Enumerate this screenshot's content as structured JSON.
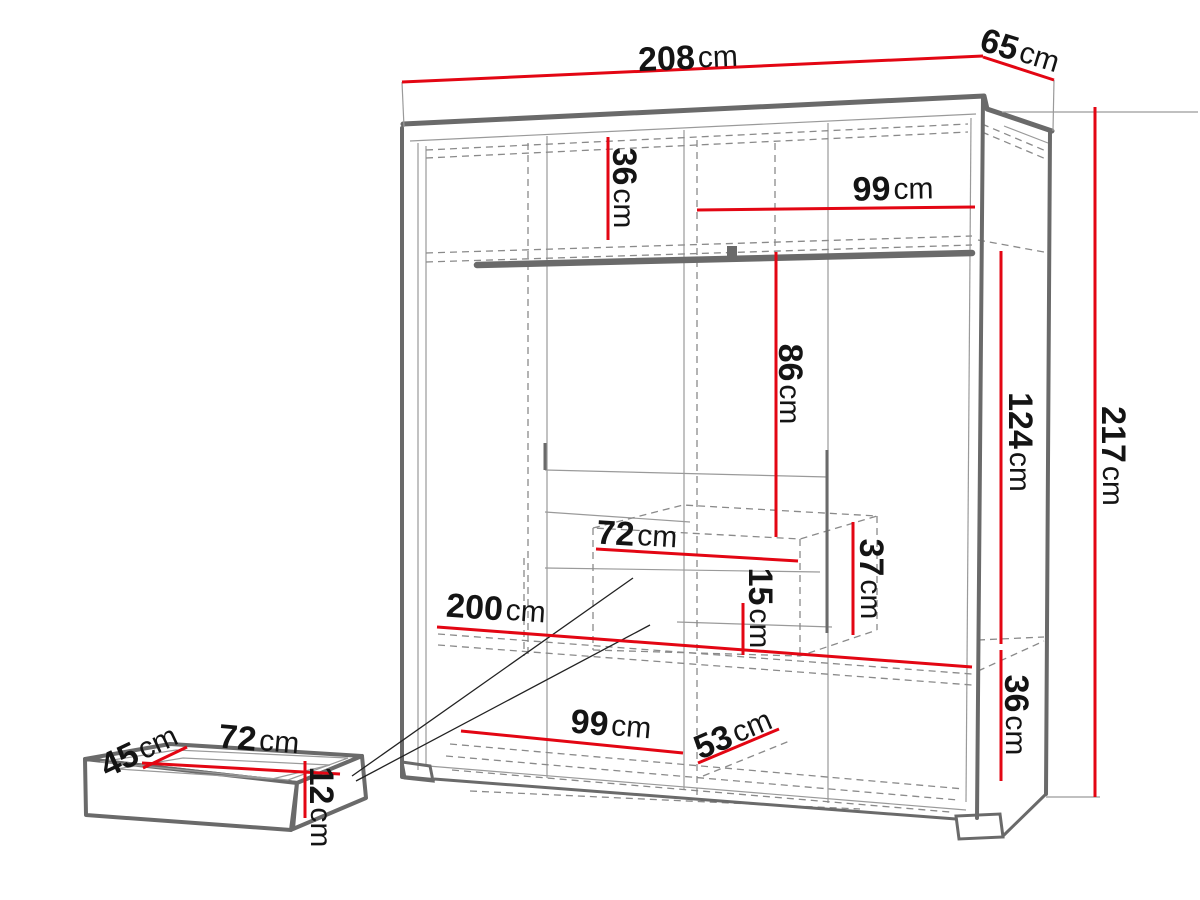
{
  "page": {
    "title": "Wardrobe dimensions technical diagram"
  },
  "colors": {
    "dimension": "#e30613",
    "outline": "#6a6a6a",
    "line": "#9a9a9a",
    "dash": "#8a8a8a",
    "text": "#141414",
    "leader": "#222222"
  },
  "diagram": {
    "dimensions": {
      "total_width": {
        "value": "208",
        "unit": "cm"
      },
      "total_depth": {
        "value": "65",
        "unit": "cm"
      },
      "total_height": {
        "value": "217",
        "unit": "cm"
      },
      "right_mid_height": {
        "value": "124",
        "unit": "cm"
      },
      "top_shelf_height": {
        "value": "36",
        "unit": "cm"
      },
      "top_shelf_width": {
        "value": "99",
        "unit": "cm"
      },
      "hanging_height": {
        "value": "86",
        "unit": "cm"
      },
      "drawer_unit_width": {
        "value": "72",
        "unit": "cm"
      },
      "drawer_unit_height": {
        "value": "37",
        "unit": "cm"
      },
      "drawer_unit_inner_height": {
        "value": "15",
        "unit": "cm"
      },
      "interior_width": {
        "value": "200",
        "unit": "cm"
      },
      "bottom_left_width": {
        "value": "99",
        "unit": "cm"
      },
      "bottom_right_depth": {
        "value": "53",
        "unit": "cm"
      },
      "bottom_shelf_height": {
        "value": "36",
        "unit": "cm"
      },
      "pullout_drawer_depth": {
        "value": "45",
        "unit": "cm"
      },
      "pullout_drawer_width": {
        "value": "72",
        "unit": "cm"
      },
      "pullout_drawer_height": {
        "value": "12",
        "unit": "cm"
      }
    }
  }
}
